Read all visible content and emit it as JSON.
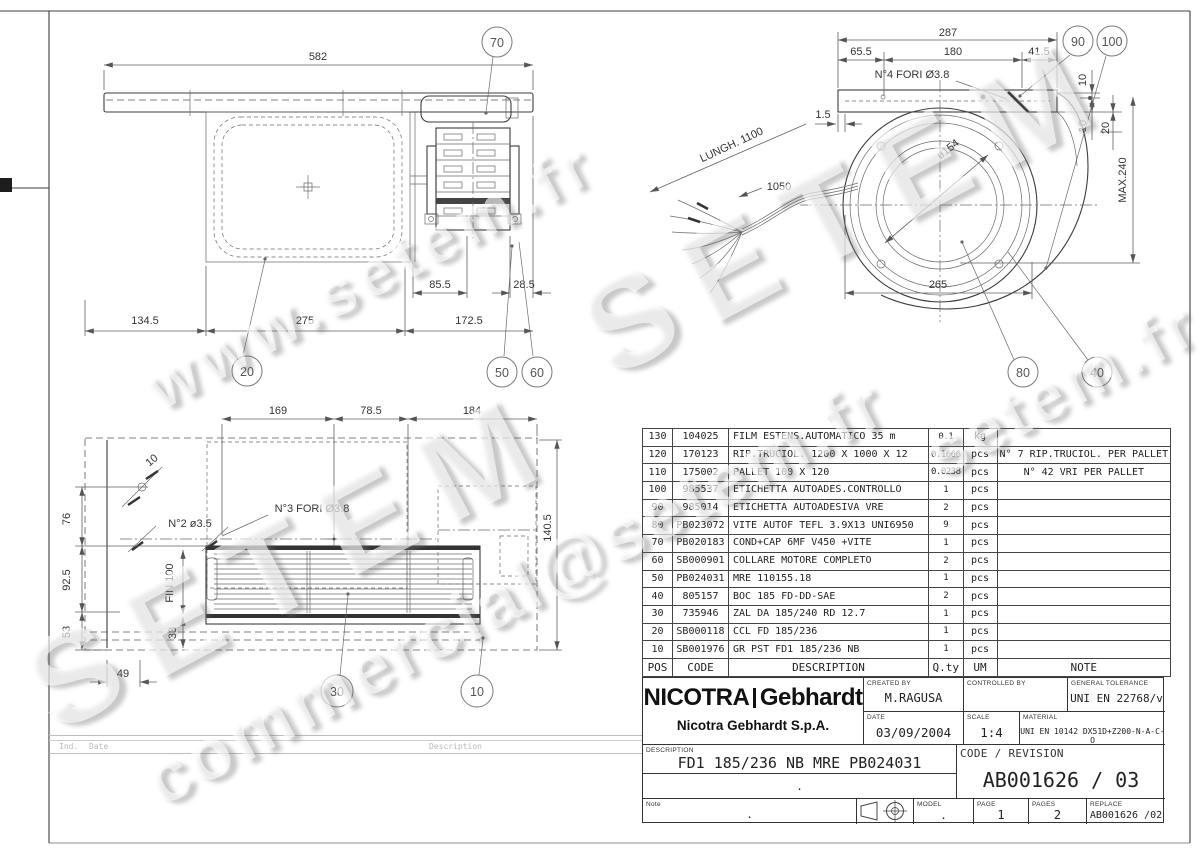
{
  "watermarks": {
    "wm1": "www.setem.fr",
    "wm2": "SETEM",
    "wm3": "SETEM",
    "wm4": "commercial@setem.fr",
    "wm5": "setem.fr"
  },
  "views": {
    "top": {
      "dims": {
        "w582": "582",
        "m855": "85.5",
        "m285": "28.5",
        "a1345": "134.5",
        "a275": "275",
        "a1725": "172.5"
      },
      "balloons": {
        "b70": "70",
        "b20": "20",
        "b50": "50",
        "b60": "60"
      }
    },
    "side": {
      "dims": {
        "d287": "287",
        "d655": "65.5",
        "d180": "180",
        "d415": "41.5",
        "fori4": "N°4 FORI Ø3.8",
        "d15": "1.5",
        "lungh": "LUNGH. 1100",
        "c1050": "1050",
        "bore": "ø154",
        "d265": "265",
        "t10a": "10",
        "t10b": "10",
        "t20": "20",
        "max": "MAX.240"
      },
      "balloons": {
        "b90": "90",
        "b100": "100",
        "b80": "80",
        "b40": "40"
      }
    },
    "front": {
      "dims": {
        "d169": "169",
        "d785": "78.5",
        "d184": "184",
        "d1405": "140.5",
        "h10": "10",
        "n2": "N°2 ø3.5",
        "n3": "N°3 FORI Ø3.8",
        "v76": "76",
        "v925": "92.5",
        "v53": "53",
        "h49": "49",
        "fin": "FIN 100",
        "v33": "33"
      },
      "balloons": {
        "b30": "30",
        "b10": "10"
      }
    }
  },
  "table": {
    "headers": {
      "pos": "POS",
      "code": "CODE",
      "desc": "DESCRIPTION",
      "qty": "Q.ty",
      "um": "UM",
      "note": "NOTE"
    },
    "rows": [
      {
        "pos": "130",
        "code": "104025",
        "desc": "FILM ESTENS.AUTOMATICO 35 m",
        "qty": "0.1",
        "um": "kg",
        "note": ""
      },
      {
        "pos": "120",
        "code": "170123",
        "desc": "RIP.TRUCIOL. 1200 X 1000 X 12",
        "qty": "0.1666",
        "um": "pcs",
        "note": "N° 7 RIP.TRUCIOL. PER PALLET"
      },
      {
        "pos": "110",
        "code": "175002",
        "desc": "PALLET 100 X 120",
        "qty": "0.0238",
        "um": "pcs",
        "note": "N° 42 VRI PER PALLET"
      },
      {
        "pos": "100",
        "code": "985537",
        "desc": "ETICHETTA AUTOADES.CONTROLLO",
        "qty": "1",
        "um": "pcs",
        "note": ""
      },
      {
        "pos": "90",
        "code": "985014",
        "desc": "ETICHETTA AUTOADESIVA VRE",
        "qty": "2",
        "um": "pcs",
        "note": ""
      },
      {
        "pos": "80",
        "code": "PB023072",
        "desc": "VITE AUTOF TEFL 3.9X13 UNI6950",
        "qty": "9",
        "um": "pcs",
        "note": ""
      },
      {
        "pos": "70",
        "code": "PB020183",
        "desc": "COND+CAP 6MF V450 +VITE",
        "qty": "1",
        "um": "pcs",
        "note": ""
      },
      {
        "pos": "60",
        "code": "SB000901",
        "desc": "COLLARE MOTORE COMPLETO",
        "qty": "2",
        "um": "pcs",
        "note": ""
      },
      {
        "pos": "50",
        "code": "PB024031",
        "desc": "MRE 110155.18",
        "qty": "1",
        "um": "pcs",
        "note": ""
      },
      {
        "pos": "40",
        "code": "805157",
        "desc": "BOC 185 FD-DD-SAE",
        "qty": "2",
        "um": "pcs",
        "note": ""
      },
      {
        "pos": "30",
        "code": "735946",
        "desc": "ZAL DA 185/240 RD  12.7",
        "qty": "1",
        "um": "pcs",
        "note": ""
      },
      {
        "pos": "20",
        "code": "SB000118",
        "desc": "CCL FD 185/236",
        "qty": "1",
        "um": "pcs",
        "note": ""
      },
      {
        "pos": "10",
        "code": "SB001976",
        "desc": "GR PST FD1 185/236 NB",
        "qty": "1",
        "um": "pcs",
        "note": ""
      }
    ]
  },
  "title_block": {
    "brand_left": "NICOTRA",
    "brand_right": "Gebhardt",
    "company": "Nicotra Gebhardt S.p.A.",
    "created_by": {
      "label": "CREATED BY",
      "value": "M.RAGUSA"
    },
    "controlled_by": {
      "label": "CONTROLLED BY",
      "value": ""
    },
    "tolerance": {
      "label": "GENERAL TOLERANCE",
      "value": "UNI EN 22768/v"
    },
    "date": {
      "label": "DATE",
      "value": "03/09/2004"
    },
    "scale": {
      "label": "SCALE",
      "value": "1:4"
    },
    "material": {
      "label": "MATERIAL",
      "value": "UNI EN 10142 DX51D+Z200-N-A-C-O"
    },
    "description": {
      "label": "DESCRIPTION",
      "value": "FD1 185/236 NB MRE PB024031"
    },
    "code_revision": {
      "label": "CODE / REVISION",
      "value": "AB001626 / 03"
    },
    "dot": ".",
    "note": {
      "label": "Note",
      "value": "."
    },
    "model": {
      "label": "MODEL",
      "value": "."
    },
    "page": {
      "label": "PAGE",
      "value": "1"
    },
    "pages": {
      "label": "PAGES",
      "value": "2"
    },
    "replace": {
      "label": "REPLACE",
      "value": "AB001626 /02"
    }
  },
  "revision_strip": {
    "ind": "Ind.",
    "date": "Date",
    "description": "Description"
  }
}
